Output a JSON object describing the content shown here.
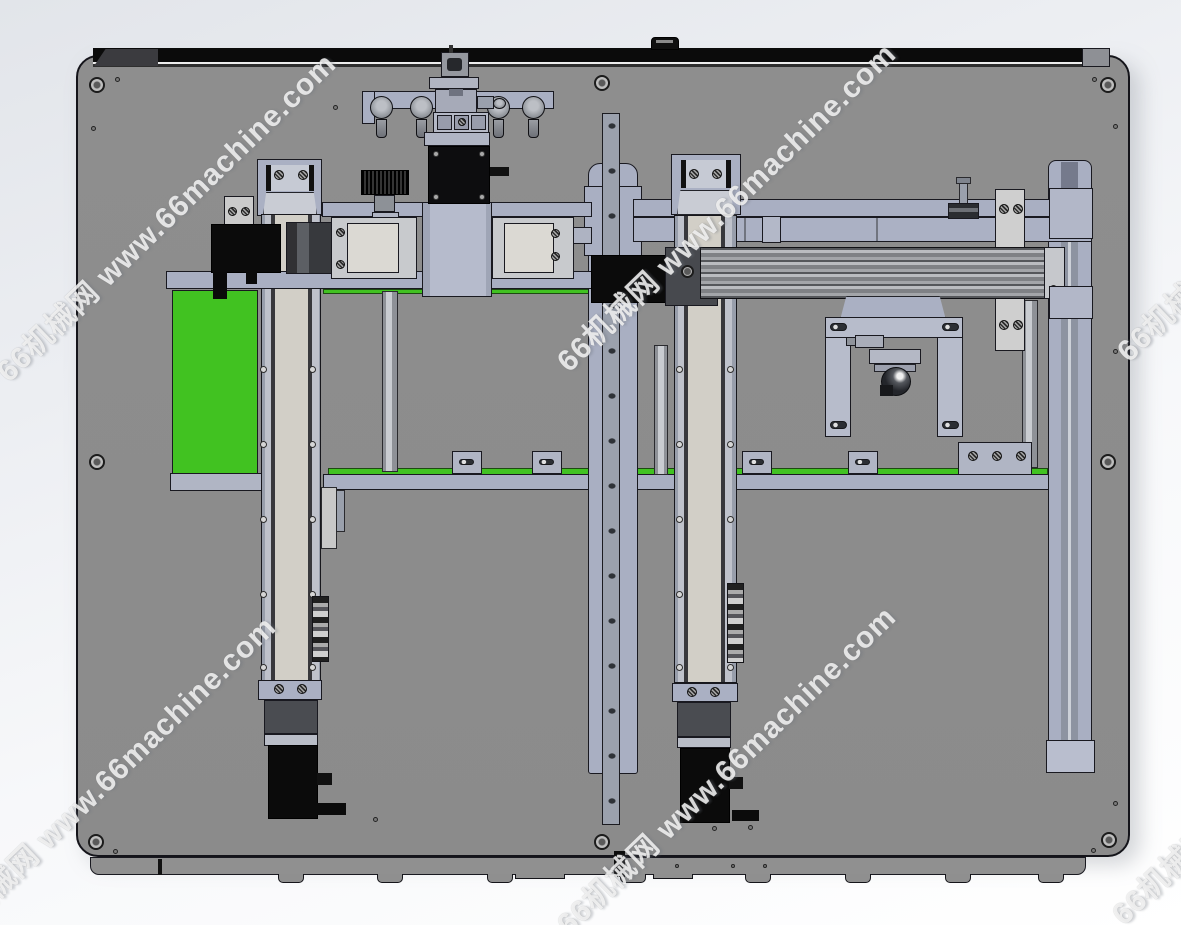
{
  "watermark": {
    "text": "66机械网 www.66machine.com"
  },
  "colors": {
    "background_top": "#e2e5ea",
    "background_bottom": "#ffffff",
    "plate": "#8b8b8b",
    "top_strip": "#0b0b0b",
    "green": "#41c221",
    "lavender": "#a9afc2",
    "lavender_light": "#b7bccb",
    "module_gray": "#c8cacd",
    "inner_panel": "#dbd9d3",
    "dark_metal": "#47494e",
    "motor_black": "#0b0b0b",
    "rail_gray": "#909090",
    "column_stripe": "#8d93a1"
  }
}
